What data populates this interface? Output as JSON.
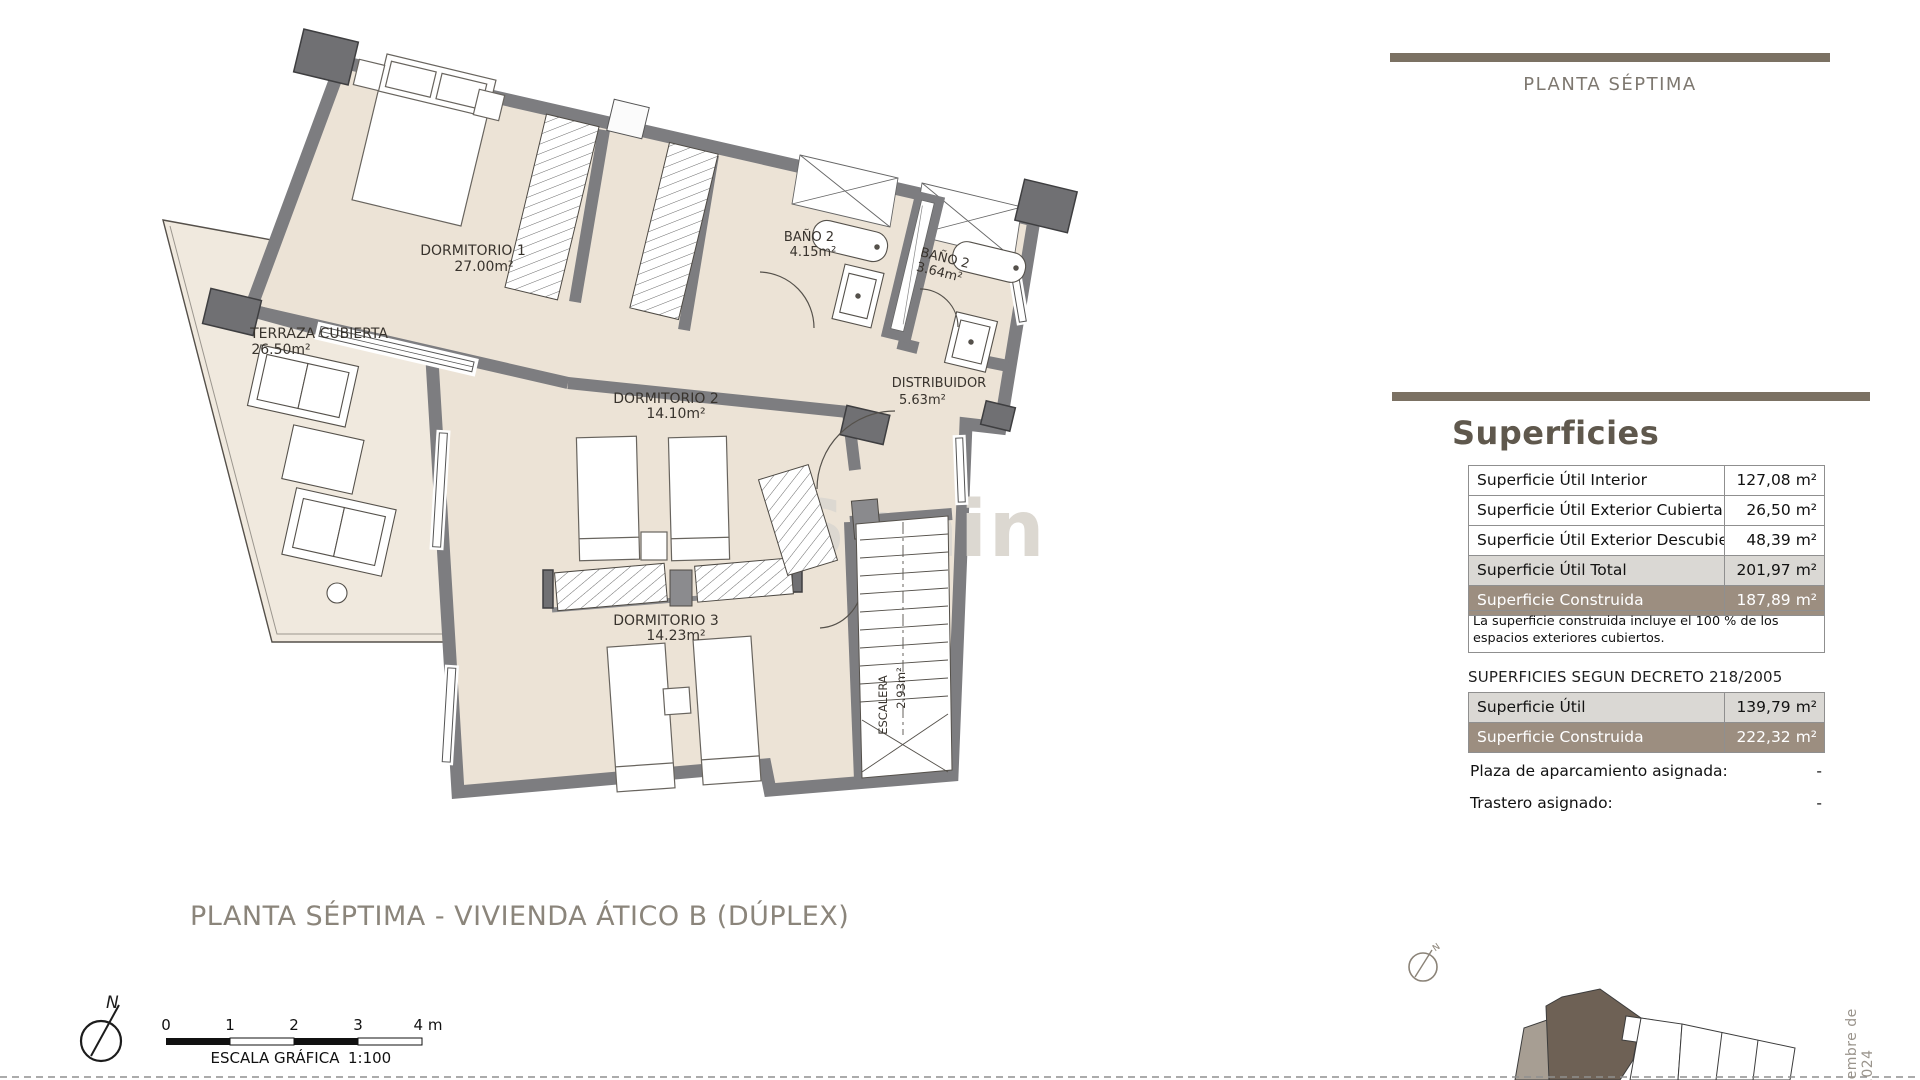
{
  "header": {
    "floor_label": "PLANTA SÉPTIMA"
  },
  "plan": {
    "title": "PLANTA SÉPTIMA - VIVIENDA ÁTICO B (DÚPLEX)",
    "watermark": "Spain",
    "rooms": [
      {
        "name": "DORMITORIO 1",
        "area": "27.00m²"
      },
      {
        "name": "TERRAZA CUBIERTA",
        "area": "26.50m²"
      },
      {
        "name": "BAÑO 2",
        "area": "4.15m²"
      },
      {
        "name": "BAÑO 2",
        "area": "3.64m²"
      },
      {
        "name": "DISTRIBUIDOR",
        "area": "5.63m²"
      },
      {
        "name": "DORMITORIO 2",
        "area": "14.10m²"
      },
      {
        "name": "DORMITORIO 3",
        "area": "14.23m²"
      },
      {
        "name": "ESCALERA",
        "area": "2.93m²"
      }
    ],
    "compass_label": "N",
    "scale": {
      "ticks": [
        "0",
        "1",
        "2",
        "3",
        "4 m"
      ],
      "caption": "ESCALA GRÁFICA",
      "ratio": "1:100"
    }
  },
  "surfaces": {
    "heading": "Superficies",
    "table1": [
      {
        "label": "Superficie Útil Interior",
        "value": "127,08",
        "unit": "m²",
        "variant": "plain"
      },
      {
        "label": "Superficie Útil Exterior Cubierta",
        "value": "26,50",
        "unit": "m²",
        "variant": "plain"
      },
      {
        "label": "Superficie Útil Exterior Descubierta",
        "value": "48,39",
        "unit": "m²",
        "variant": "plain"
      },
      {
        "label": "Superficie Útil Total",
        "value": "201,97",
        "unit": "m²",
        "variant": "gray"
      },
      {
        "label": "Superficie Construida",
        "value": "187,89",
        "unit": "m²",
        "variant": "brown"
      }
    ],
    "note": "La superficie construida incluye el 100 % de los espacios exteriores cubiertos.",
    "decreto_heading": "SUPERFICIES SEGUN DECRETO 218/2005",
    "table2": [
      {
        "label": "Superficie Útil",
        "value": "139,79",
        "unit": "m²",
        "variant": "gray"
      },
      {
        "label": "Superficie Construida",
        "value": "222,32",
        "unit": "m²",
        "variant": "brown"
      }
    ],
    "extras": [
      {
        "label": "Plaza de aparcamiento asignada:",
        "value": "-"
      },
      {
        "label": "Trastero asignado:",
        "value": "-"
      }
    ]
  },
  "footer": {
    "date_text": "ciembre de 2.024"
  },
  "colors": {
    "accent_bar": "#7b7163",
    "row_brown": "#9c8e80",
    "row_gray": "#dad8d4",
    "floor": "#ece3d6",
    "terrace": "#f0e9de",
    "wall": "#7d7d80"
  }
}
